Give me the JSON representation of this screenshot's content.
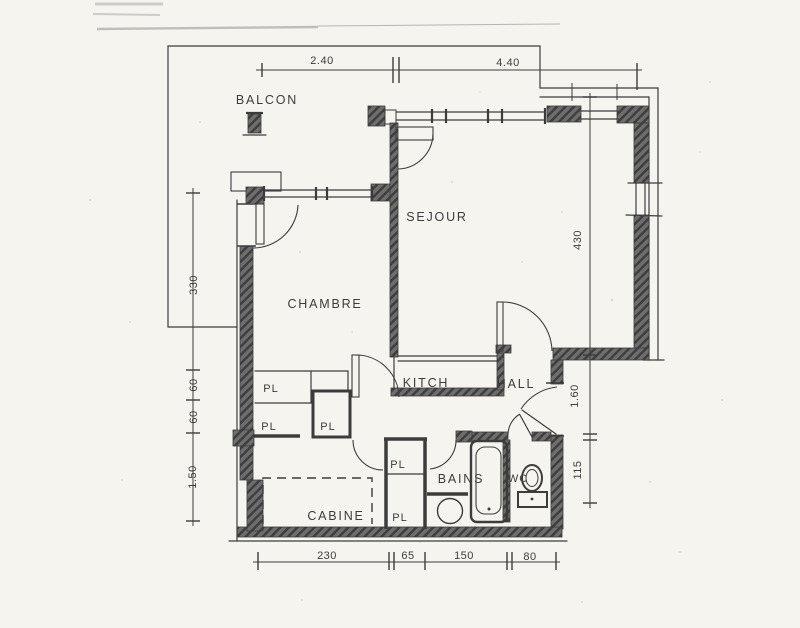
{
  "rooms": {
    "balcon": "BALCON",
    "sejour": "SEJOUR",
    "chambre": "CHAMBRE",
    "kitch": "KITCH",
    "hall": "HALL",
    "bains": "BAINS",
    "wc": "WC",
    "cabine": "CABINE"
  },
  "pl": [
    "PL",
    "PL",
    "PL",
    "PL",
    "PL"
  ],
  "dims": {
    "top": [
      "2.40",
      "4.40"
    ],
    "left": [
      "330",
      "60",
      "60",
      "1.50"
    ],
    "right": [
      "430",
      "1.60",
      "115"
    ],
    "bottom": [
      "230",
      "65",
      "150",
      "80"
    ]
  },
  "colors": {
    "paper": "#f6f4ef",
    "ink": "#3c3c3c",
    "wall": "#6e6e6e"
  }
}
